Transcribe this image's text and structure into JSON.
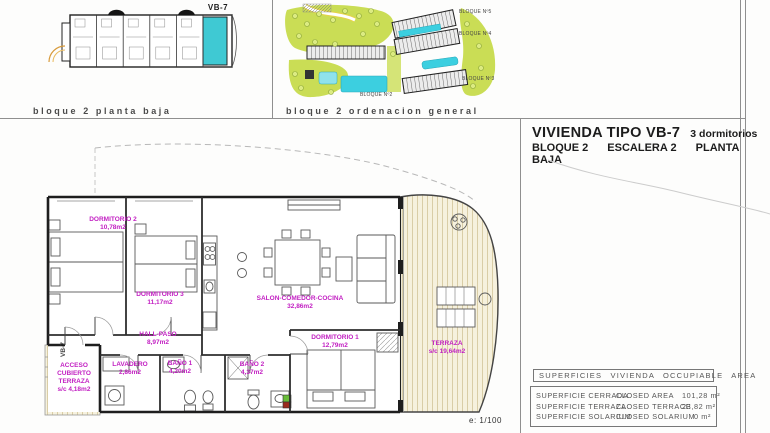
{
  "panels": {
    "block_plan": {
      "caption": "bloque 2 planta baja",
      "unit_label": "VB-7"
    },
    "site_plan": {
      "caption": "bloque 2 ordenacion general",
      "block_labels": [
        "BLOQUE Nº5",
        "BLOQUE Nº4",
        "BLOQUE Nº3",
        "BLOQUE Nº2"
      ]
    }
  },
  "title_block": {
    "type_title": "VIVIENDA TIPO VB-7",
    "bedrooms": "3 dormitorios",
    "subtitle_parts": [
      "BLOQUE 2",
      "ESCALERA 2",
      "PLANTA BAJA"
    ]
  },
  "plan": {
    "unit_tag": "VB-7",
    "scale": "e: 1/100",
    "rooms": [
      {
        "name": "DORMITORIO 2",
        "area": "10,78m2"
      },
      {
        "name": "DORMITORIO 3",
        "area": "11,17m2"
      },
      {
        "name": "SALON-COMEDOR-COCINA",
        "area": "32,86m2"
      },
      {
        "name": "HALL-PASO",
        "area": "8,97m2"
      },
      {
        "name": "DORMITORIO 1",
        "area": "12,79m2"
      },
      {
        "name": "TERRAZA",
        "area": "s/c 19,64m2"
      },
      {
        "name": "LAVADERO",
        "area": "2,86m2"
      },
      {
        "name": "BAÑO 1",
        "area": "4,20m2"
      },
      {
        "name": "BAÑO 2",
        "area": "4,37m2"
      },
      {
        "name": "ACCESO CUBIERTO TERRAZA",
        "area": "s/c 4,18m2"
      }
    ]
  },
  "surfaces": {
    "header": "SUPERFICIES VIVIENDA OCCUPIABLE AREA",
    "rows": [
      {
        "label_es": "SUPERFICIE CERRADA",
        "label_en": "CLOSED AREA",
        "value": "101,28 m²"
      },
      {
        "label_es": "SUPERFICIE TERRAZA",
        "label_en": "CLOSED TERRACE",
        "value": "23,82 m²"
      },
      {
        "label_es": "SUPERFICIE SOLARIUM",
        "label_en": "CLOSED SOLARIUM",
        "value": "0 m²"
      }
    ]
  },
  "colors": {
    "highlight_unit": "#3fc9d3",
    "room_label": "#c21fc2",
    "pool": "#3ccfe0",
    "green": "#cadd55"
  }
}
